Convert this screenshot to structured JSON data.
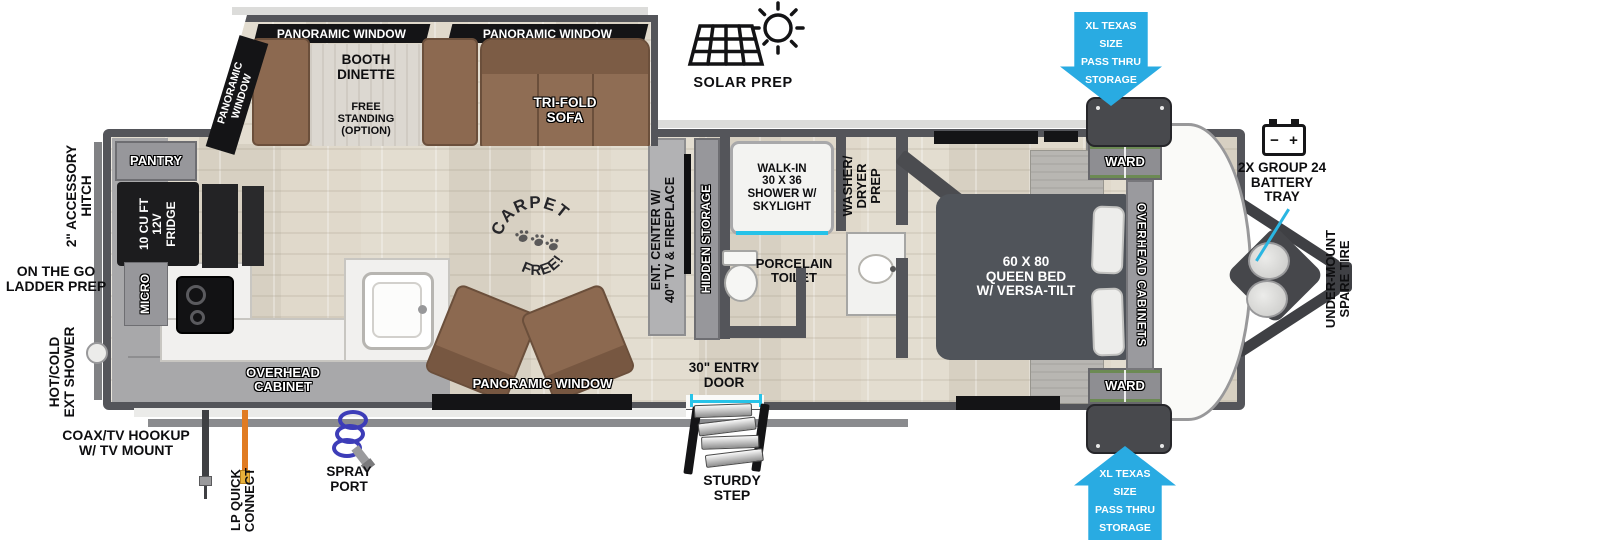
{
  "labels": {
    "panoramic_window": "PANORAMIC WINDOW",
    "panoramic_window_2line": "PANORAMIC\nWINDOW"
  },
  "slideout": {
    "booth_dinette": "BOOTH\nDINETTE",
    "free_standing": "FREE\nSTANDING\n(OPTION)",
    "trifold_sofa": "TRI-FOLD\nSOFA"
  },
  "kitchen": {
    "pantry": "PANTRY",
    "fridge": "10 CU FT\n12V\nFRIDGE",
    "micro": "MICRO",
    "overhead_cabinet": "OVERHEAD\nCABINET"
  },
  "living": {
    "carpet_free_top": "CARPET",
    "carpet_free_bottom": "FREE!",
    "ent_center": "ENT. CENTER W/\n40\" TV & FIREPLACE",
    "hidden_storage": "HIDDEN STORAGE"
  },
  "bathroom": {
    "shower": "WALK-IN\n30 X 36\nSHOWER W/\nSKYLIGHT",
    "toilet": "PORCELAIN\nTOILET",
    "washer_dryer": "WASHER/\nDRYER\nPREP"
  },
  "bedroom": {
    "bed": "60 X 80\nQUEEN BED\nW/ VERSA-TILT",
    "ward": "WARD",
    "overhead_cabinets": "OVERHEAD CABINETS"
  },
  "exterior": {
    "solar_prep": "SOLAR PREP",
    "pass_thru": "XL TEXAS SIZE\nPASS THRU\nSTORAGE",
    "battery": "2X GROUP 24\nBATTERY\nTRAY",
    "battery_minus": "−",
    "battery_plus": "+",
    "spare_tire": "UNDER-MOUNT\nSPARE TIRE",
    "accessory_hitch": "2\" ACCESSORY\nHITCH",
    "ladder_prep": "ON THE GO\nLADDER PREP",
    "ext_shower": "HOT/COLD\nEXT SHOWER",
    "coax": "COAX/TV HOOKUP\nW/ TV MOUNT",
    "lp_connect": "LP QUICK\nCONNECT",
    "spray_port": "SPRAY\nPORT",
    "entry_door": "30\" ENTRY\nDOOR",
    "sturdy_step": "STURDY\nSTEP"
  }
}
